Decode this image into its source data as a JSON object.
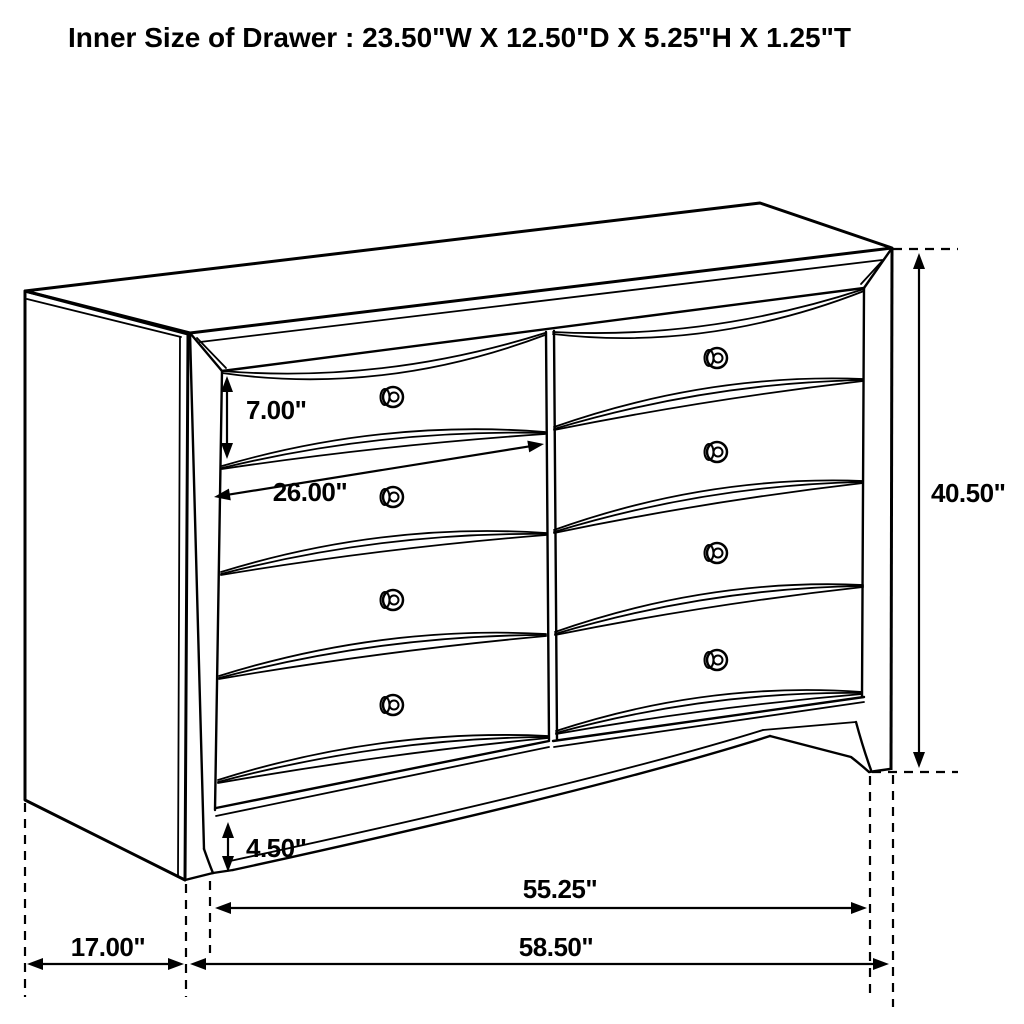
{
  "title": "Inner Size of Drawer : 23.50\"W X 12.50\"D X 5.25\"H X 1.25\"T",
  "diagram": {
    "type": "furniture-dimension-line-drawing",
    "subject": "dresser with 8 drawers (2 columns x 4 rows), round knobs, bracket feet",
    "inner_drawer_size": {
      "width": "23.50\"",
      "depth": "12.50\"",
      "height": "5.25\"",
      "thickness": "1.25\""
    },
    "labels": {
      "drawer_front_height": "7.00\"",
      "drawer_width": "26.00\"",
      "overall_height": "40.50\"",
      "base_rail_height": "4.50\"",
      "case_width": "55.25\"",
      "overall_width": "58.50\"",
      "side_depth": "17.00\""
    },
    "colors": {
      "line": "#000000",
      "background": "#ffffff",
      "text": "#000000"
    }
  }
}
